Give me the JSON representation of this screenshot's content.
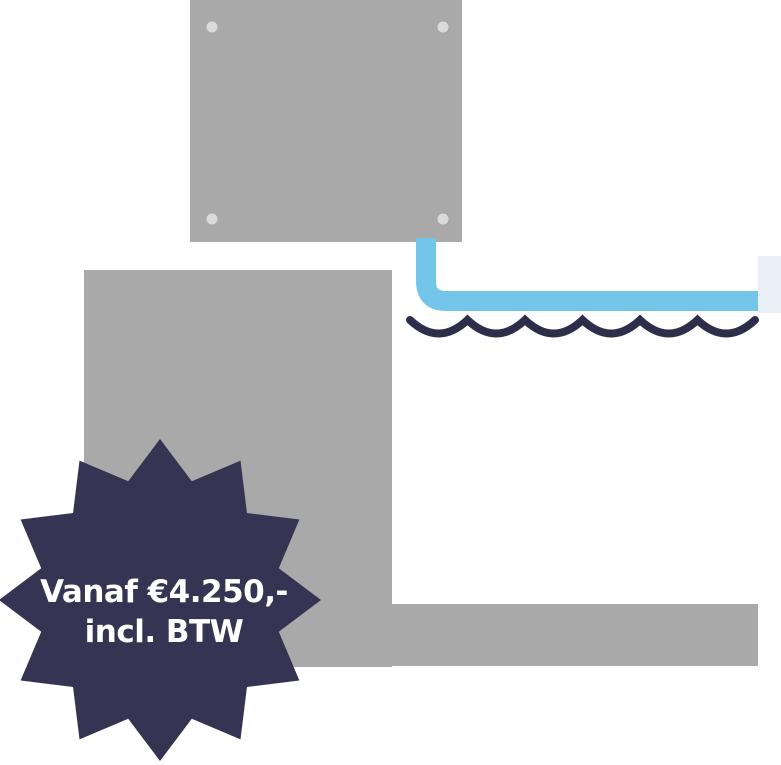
{
  "badge": {
    "line1": "Vanaf €4.250,-",
    "line2": "incl. BTW"
  },
  "colors": {
    "background": "#ffffff",
    "structure_gray": "#a9a9a9",
    "screw_gray": "#dadada",
    "pipe_blue": "#74c5ea",
    "outlet_light": "#e9f0f7",
    "wave_navy": "#2c2e4a",
    "badge_navy": "#353452",
    "badge_text": "#ffffff"
  }
}
